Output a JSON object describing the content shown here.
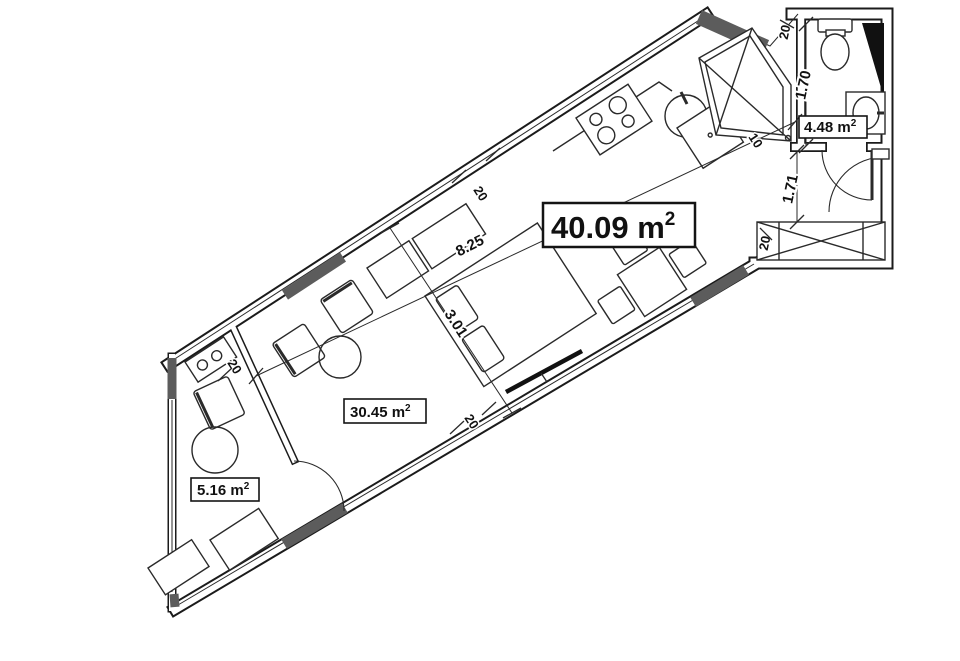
{
  "areas": {
    "total": {
      "value": "40.09 m",
      "sup": "2"
    },
    "living": {
      "value": "30.45 m",
      "sup": "2"
    },
    "balcony": {
      "value": "5.16 m",
      "sup": "2"
    },
    "bathroom": {
      "value": "4.48 m",
      "sup": "2"
    }
  },
  "dimensions": {
    "room_length": "8.25",
    "room_width": "3.01",
    "bathroom_width": "1.70",
    "hall_width": "1.71",
    "wall_thickness": "20",
    "wall_thin": "10"
  },
  "colors": {
    "background": "#ffffff",
    "wall_line": "#1b1b1b",
    "wall_pier_fill": "#5c5c5c",
    "fixture_panel": "#111111",
    "label_text": "#111111"
  }
}
